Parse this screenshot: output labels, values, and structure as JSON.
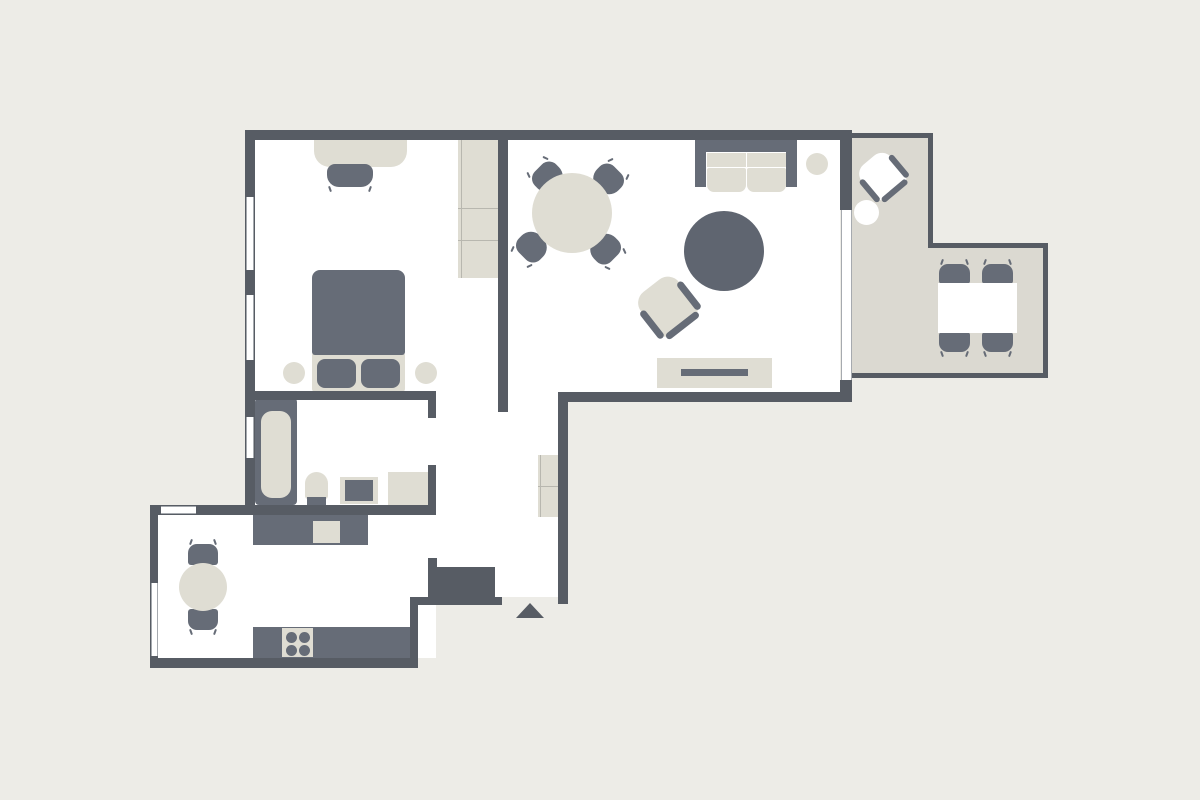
{
  "canvas": {
    "w": 1200,
    "h": 800
  },
  "colors": {
    "bg": "#EDECE7",
    "wall": "#575C64",
    "floor": "#FFFFFF",
    "balcony": "#DBD9D1",
    "furnLight": "#DFDDD3",
    "furnDark": "#666C77",
    "rug": "#5F6570",
    "white": "#FFFFFF",
    "line": "#B8B7AF",
    "winline": "#A6AAAF"
  },
  "shapes": [
    {
      "name": "bedroom-living-floor",
      "x": 255,
      "y": 140,
      "w": 585,
      "h": 252,
      "fill": "floor"
    },
    {
      "name": "hallway-floor",
      "x": 436,
      "y": 385,
      "w": 124,
      "h": 212,
      "fill": "floor"
    },
    {
      "name": "bathroom-floor",
      "x": 250,
      "y": 392,
      "w": 186,
      "h": 116,
      "fill": "floor"
    },
    {
      "name": "kitchen-floor",
      "x": 158,
      "y": 506,
      "w": 278,
      "h": 152,
      "fill": "floor"
    },
    {
      "name": "balcony-floor-upper",
      "x": 852,
      "y": 133,
      "w": 81,
      "h": 245,
      "fill": "balcony"
    },
    {
      "name": "balcony-floor-lower",
      "x": 933,
      "y": 243,
      "w": 115,
      "h": 135,
      "fill": "balcony"
    },
    {
      "name": "balcony-rail-top",
      "x": 852,
      "y": 133,
      "w": 81,
      "h": 5,
      "fill": "wall"
    },
    {
      "name": "balcony-rail-right-upper",
      "x": 928,
      "y": 133,
      "w": 5,
      "h": 115,
      "fill": "wall"
    },
    {
      "name": "balcony-rail-middle",
      "x": 933,
      "y": 243,
      "w": 115,
      "h": 5,
      "fill": "wall"
    },
    {
      "name": "balcony-rail-right-lower",
      "x": 1043,
      "y": 243,
      "w": 5,
      "h": 135,
      "fill": "wall"
    },
    {
      "name": "balcony-rail-bottom",
      "x": 852,
      "y": 373,
      "w": 196,
      "h": 5,
      "fill": "wall"
    },
    {
      "name": "desk",
      "x": 314,
      "y": 140,
      "w": 93,
      "h": 27,
      "fill": "furnLight",
      "r": "0 0 16px 16px"
    },
    {
      "name": "desk-chair",
      "x": 327,
      "y": 164,
      "w": 46,
      "h": 23,
      "fill": "furnDark",
      "r": "8px 8px 12px 12px",
      "cls": "ticks-bottom"
    },
    {
      "name": "bedroom-wardrobe",
      "x": 458,
      "y": 140,
      "w": 40,
      "h": 138,
      "fill": "furnLight"
    },
    {
      "name": "bedroom-wardrobe-side-line",
      "x": 461,
      "y": 140,
      "w": 1,
      "h": 138,
      "fill": "line"
    },
    {
      "name": "bedroom-wardrobe-shelf-line-1",
      "x": 458,
      "y": 208,
      "w": 40,
      "h": 1,
      "fill": "line"
    },
    {
      "name": "bedroom-wardrobe-shelf-line-2",
      "x": 458,
      "y": 240,
      "w": 40,
      "h": 1,
      "fill": "line"
    },
    {
      "name": "bed-sheet",
      "x": 312,
      "y": 352,
      "w": 93,
      "h": 40,
      "fill": "furnLight",
      "r": "3px"
    },
    {
      "name": "bed-duvet",
      "x": 312,
      "y": 270,
      "w": 93,
      "h": 85,
      "fill": "furnDark",
      "r": "8px 8px 3px 3px"
    },
    {
      "name": "bed-pillow-left",
      "x": 317,
      "y": 359,
      "w": 39,
      "h": 29,
      "fill": "furnDark",
      "r": "8px"
    },
    {
      "name": "bed-pillow-right",
      "x": 361,
      "y": 359,
      "w": 39,
      "h": 29,
      "fill": "furnDark",
      "r": "8px"
    },
    {
      "name": "nightstand-left",
      "type": "circle",
      "x": 283,
      "y": 362,
      "w": 22,
      "h": 22,
      "fill": "furnLight"
    },
    {
      "name": "nightstand-right",
      "type": "circle",
      "x": 415,
      "y": 362,
      "w": 22,
      "h": 22,
      "fill": "furnLight"
    },
    {
      "name": "dining-chair-nw",
      "x": 533,
      "y": 164,
      "w": 30,
      "h": 27,
      "fill": "furnDark",
      "r": "10px 10px 13px 13px",
      "rot": -45,
      "cls": "ticks-top"
    },
    {
      "name": "dining-chair-ne",
      "x": 593,
      "y": 166,
      "w": 30,
      "h": 27,
      "fill": "furnDark",
      "r": "10px 10px 13px 13px",
      "rot": 45,
      "cls": "ticks-top"
    },
    {
      "name": "dining-chair-sw",
      "x": 517,
      "y": 233,
      "w": 30,
      "h": 27,
      "fill": "furnDark",
      "r": "10px 10px 13px 13px",
      "rot": -135,
      "cls": "ticks-top"
    },
    {
      "name": "dining-chair-se",
      "x": 590,
      "y": 235,
      "w": 30,
      "h": 27,
      "fill": "furnDark",
      "r": "10px 10px 13px 13px",
      "rot": 135,
      "cls": "ticks-top"
    },
    {
      "name": "dining-table",
      "type": "circle",
      "x": 532,
      "y": 173,
      "w": 80,
      "h": 80,
      "fill": "furnLight"
    },
    {
      "name": "sofa-back",
      "x": 695,
      "y": 140,
      "w": 102,
      "h": 12,
      "fill": "furnDark"
    },
    {
      "name": "sofa-arm-left",
      "x": 695,
      "y": 140,
      "w": 11,
      "h": 47,
      "fill": "furnDark"
    },
    {
      "name": "sofa-arm-right",
      "x": 786,
      "y": 140,
      "w": 11,
      "h": 47,
      "fill": "furnDark"
    },
    {
      "name": "sofa-cushion-back-left",
      "x": 707,
      "y": 153,
      "w": 39,
      "h": 14,
      "fill": "furnLight"
    },
    {
      "name": "sofa-cushion-back-right",
      "x": 747,
      "y": 153,
      "w": 39,
      "h": 14,
      "fill": "furnLight"
    },
    {
      "name": "sofa-cushion-seat-left",
      "x": 707,
      "y": 168,
      "w": 39,
      "h": 24,
      "fill": "furnLight",
      "r": "2px 2px 7px 7px"
    },
    {
      "name": "sofa-cushion-seat-right",
      "x": 747,
      "y": 168,
      "w": 39,
      "h": 24,
      "fill": "furnLight",
      "r": "2px 2px 7px 7px"
    },
    {
      "name": "sofa-side-table",
      "type": "circle",
      "x": 806,
      "y": 153,
      "w": 22,
      "h": 22,
      "fill": "furnLight"
    },
    {
      "name": "round-rug",
      "type": "circle",
      "x": 684,
      "y": 211,
      "w": 80,
      "h": 80,
      "fill": "rug"
    },
    {
      "name": "armchair",
      "x": 641,
      "y": 280,
      "w": 54,
      "h": 54,
      "rot": -38,
      "children": [
        {
          "name": "armchair-body",
          "x": 3,
          "y": 0,
          "w": 48,
          "h": 50,
          "fill": "furnLight",
          "r": "14px 14px 8px 8px"
        },
        {
          "name": "armchair-arm-left",
          "x": 0,
          "y": 14,
          "w": 7,
          "h": 34,
          "fill": "furnDark",
          "r": "4px"
        },
        {
          "name": "armchair-arm-right",
          "x": 47,
          "y": 14,
          "w": 7,
          "h": 34,
          "fill": "furnDark",
          "r": "4px"
        },
        {
          "name": "armchair-back",
          "x": 7,
          "y": 47,
          "w": 40,
          "h": 7,
          "fill": "furnDark",
          "r": "4px"
        }
      ]
    },
    {
      "name": "tv-sideboard",
      "x": 657,
      "y": 358,
      "w": 115,
      "h": 30,
      "fill": "furnLight"
    },
    {
      "name": "tv",
      "x": 681,
      "y": 369,
      "w": 67,
      "h": 7,
      "fill": "furnDark"
    },
    {
      "name": "balcony-lounge-chair",
      "x": 861,
      "y": 155,
      "w": 44,
      "h": 44,
      "rot": -40,
      "children": [
        {
          "name": "balcony-lounge-chair-body",
          "x": 3,
          "y": 0,
          "w": 38,
          "h": 40,
          "fill": "white",
          "r": "12px 12px 7px 7px"
        },
        {
          "name": "balcony-lounge-chair-arm-left",
          "x": 0,
          "y": 10,
          "w": 6,
          "h": 28,
          "fill": "furnDark",
          "r": "3px"
        },
        {
          "name": "balcony-lounge-chair-arm-right",
          "x": 38,
          "y": 10,
          "w": 6,
          "h": 28,
          "fill": "furnDark",
          "r": "3px"
        },
        {
          "name": "balcony-lounge-chair-back",
          "x": 6,
          "y": 37,
          "w": 32,
          "h": 6,
          "fill": "furnDark",
          "r": "3px"
        }
      ]
    },
    {
      "name": "balcony-side-table",
      "type": "circle",
      "x": 854,
      "y": 200,
      "w": 25,
      "h": 25,
      "fill": "white"
    },
    {
      "name": "balcony-chair-1",
      "x": 939,
      "y": 264,
      "w": 31,
      "h": 20,
      "fill": "furnDark",
      "r": "9px 9px 3px 3px",
      "cls": "ticks-top"
    },
    {
      "name": "balcony-chair-2",
      "x": 982,
      "y": 264,
      "w": 31,
      "h": 20,
      "fill": "furnDark",
      "r": "9px 9px 3px 3px",
      "cls": "ticks-top"
    },
    {
      "name": "balcony-chair-3",
      "x": 939,
      "y": 332,
      "w": 31,
      "h": 20,
      "fill": "furnDark",
      "r": "3px 3px 9px 9px",
      "cls": "ticks-bottom"
    },
    {
      "name": "balcony-chair-4",
      "x": 982,
      "y": 332,
      "w": 31,
      "h": 20,
      "fill": "furnDark",
      "r": "3px 3px 9px 9px",
      "cls": "ticks-bottom"
    },
    {
      "name": "balcony-table",
      "x": 938,
      "y": 283,
      "w": 79,
      "h": 50,
      "fill": "white"
    },
    {
      "name": "bathtub",
      "x": 255,
      "y": 398,
      "w": 42,
      "h": 107,
      "fill": "furnDark",
      "r": "4px"
    },
    {
      "name": "bathtub-inner",
      "x": 261,
      "y": 411,
      "w": 30,
      "h": 87,
      "fill": "furnLight",
      "r": "11px"
    },
    {
      "name": "toilet-bowl",
      "x": 305,
      "y": 472,
      "w": 23,
      "h": 27,
      "fill": "furnLight",
      "r": "12px 12px 3px 3px"
    },
    {
      "name": "toilet-tank",
      "x": 307,
      "y": 497,
      "w": 19,
      "h": 10,
      "fill": "furnDark"
    },
    {
      "name": "sink-counter",
      "x": 340,
      "y": 477,
      "w": 38,
      "h": 27,
      "fill": "furnLight"
    },
    {
      "name": "sink-basin",
      "x": 345,
      "y": 480,
      "w": 28,
      "h": 21,
      "fill": "furnDark"
    },
    {
      "name": "washing-machine",
      "x": 388,
      "y": 472,
      "w": 40,
      "h": 34,
      "fill": "furnLight"
    },
    {
      "name": "kitchen-counter-top",
      "x": 253,
      "y": 513,
      "w": 115,
      "h": 32,
      "fill": "furnDark"
    },
    {
      "name": "kitchen-sink",
      "x": 313,
      "y": 521,
      "w": 27,
      "h": 22,
      "fill": "furnLight"
    },
    {
      "name": "kitchen-counter-bottom",
      "x": 253,
      "y": 627,
      "w": 159,
      "h": 31,
      "fill": "furnDark"
    },
    {
      "name": "stove",
      "x": 282,
      "y": 628,
      "w": 31,
      "h": 29,
      "fill": "furnLight"
    },
    {
      "name": "stove-burner-1",
      "type": "circle",
      "x": 286,
      "y": 632,
      "w": 11,
      "h": 11,
      "fill": "furnDark"
    },
    {
      "name": "stove-burner-2",
      "type": "circle",
      "x": 299,
      "y": 632,
      "w": 11,
      "h": 11,
      "fill": "furnDark"
    },
    {
      "name": "stove-burner-3",
      "type": "circle",
      "x": 286,
      "y": 645,
      "w": 11,
      "h": 11,
      "fill": "furnDark"
    },
    {
      "name": "stove-burner-4",
      "type": "circle",
      "x": 299,
      "y": 645,
      "w": 11,
      "h": 11,
      "fill": "furnDark"
    },
    {
      "name": "kitchen-chair-top",
      "x": 188,
      "y": 544,
      "w": 30,
      "h": 21,
      "fill": "furnDark",
      "r": "9px 9px 3px 3px",
      "cls": "ticks-top"
    },
    {
      "name": "kitchen-chair-bottom",
      "x": 188,
      "y": 609,
      "w": 30,
      "h": 21,
      "fill": "furnDark",
      "r": "3px 3px 9px 9px",
      "cls": "ticks-bottom"
    },
    {
      "name": "kitchen-table",
      "type": "circle",
      "x": 179,
      "y": 563,
      "w": 48,
      "h": 48,
      "fill": "furnLight"
    },
    {
      "name": "hall-wardrobe",
      "x": 538,
      "y": 455,
      "w": 22,
      "h": 62,
      "fill": "furnLight"
    },
    {
      "name": "hall-wardrobe-shelf-line",
      "x": 538,
      "y": 486,
      "w": 22,
      "h": 1,
      "fill": "line"
    },
    {
      "name": "hall-wardrobe-side-line",
      "x": 540,
      "y": 455,
      "w": 1,
      "h": 62,
      "fill": "line"
    },
    {
      "name": "entry-closet-stub",
      "x": 428,
      "y": 558,
      "w": 9,
      "h": 42,
      "fill": "wall"
    },
    {
      "name": "entry-closet",
      "x": 437,
      "y": 567,
      "w": 58,
      "h": 30,
      "fill": "wall"
    },
    {
      "name": "wall-top",
      "x": 245,
      "y": 130,
      "w": 607,
      "h": 10,
      "fill": "wall"
    },
    {
      "name": "wall-left",
      "x": 245,
      "y": 130,
      "w": 10,
      "h": 385,
      "fill": "wall"
    },
    {
      "name": "wall-bedroom-living-divider",
      "x": 498,
      "y": 140,
      "w": 10,
      "h": 272,
      "fill": "wall"
    },
    {
      "name": "wall-bedroom-bottom",
      "x": 255,
      "y": 391,
      "w": 181,
      "h": 9,
      "fill": "wall"
    },
    {
      "name": "wall-bathroom-right-upper",
      "x": 428,
      "y": 398,
      "w": 8,
      "h": 20,
      "fill": "wall"
    },
    {
      "name": "wall-bathroom-right-lower",
      "x": 428,
      "y": 465,
      "w": 8,
      "h": 50,
      "fill": "wall"
    },
    {
      "name": "wall-kitchen-top",
      "x": 150,
      "y": 505,
      "w": 286,
      "h": 10,
      "fill": "wall"
    },
    {
      "name": "wall-kitchen-left",
      "x": 150,
      "y": 505,
      "w": 8,
      "h": 163,
      "fill": "wall"
    },
    {
      "name": "wall-kitchen-bottom",
      "x": 150,
      "y": 658,
      "w": 268,
      "h": 10,
      "fill": "wall"
    },
    {
      "name": "wall-kitchen-right",
      "x": 410,
      "y": 597,
      "w": 8,
      "h": 71,
      "fill": "wall"
    },
    {
      "name": "wall-entry-bottom",
      "x": 410,
      "y": 597,
      "w": 92,
      "h": 8,
      "fill": "wall"
    },
    {
      "name": "wall-hall-right",
      "x": 558,
      "y": 392,
      "w": 10,
      "h": 212,
      "fill": "wall"
    },
    {
      "name": "wall-living-bottom",
      "x": 558,
      "y": 392,
      "w": 294,
      "h": 10,
      "fill": "wall"
    },
    {
      "name": "wall-living-right-upper",
      "x": 840,
      "y": 130,
      "w": 12,
      "h": 80,
      "fill": "wall"
    },
    {
      "name": "wall-living-right-lower",
      "x": 840,
      "y": 380,
      "w": 12,
      "h": 22,
      "fill": "wall"
    },
    {
      "name": "window-bedroom-1",
      "cls": "win-v",
      "x": 246,
      "y": 197,
      "w": 8,
      "h": 73,
      "fill": "floor"
    },
    {
      "name": "window-bedroom-2",
      "cls": "win-v",
      "x": 246,
      "y": 295,
      "w": 8,
      "h": 65,
      "fill": "floor"
    },
    {
      "name": "window-bathroom",
      "cls": "win-v",
      "x": 246,
      "y": 417,
      "w": 8,
      "h": 41,
      "fill": "floor"
    },
    {
      "name": "window-kitchen-top",
      "cls": "win-h",
      "x": 161,
      "y": 506,
      "w": 35,
      "h": 8,
      "fill": "floor"
    },
    {
      "name": "window-kitchen-left",
      "cls": "win-v",
      "x": 151,
      "y": 583,
      "w": 7,
      "h": 73,
      "fill": "floor"
    },
    {
      "name": "balcony-door-window",
      "cls": "win-v",
      "x": 841,
      "y": 210,
      "w": 11,
      "h": 170,
      "fill": "floor"
    },
    {
      "name": "entrance-arrow",
      "type": "triangle",
      "x": 516,
      "y": 603,
      "w": 28,
      "h": 15,
      "fill": "wall"
    }
  ]
}
